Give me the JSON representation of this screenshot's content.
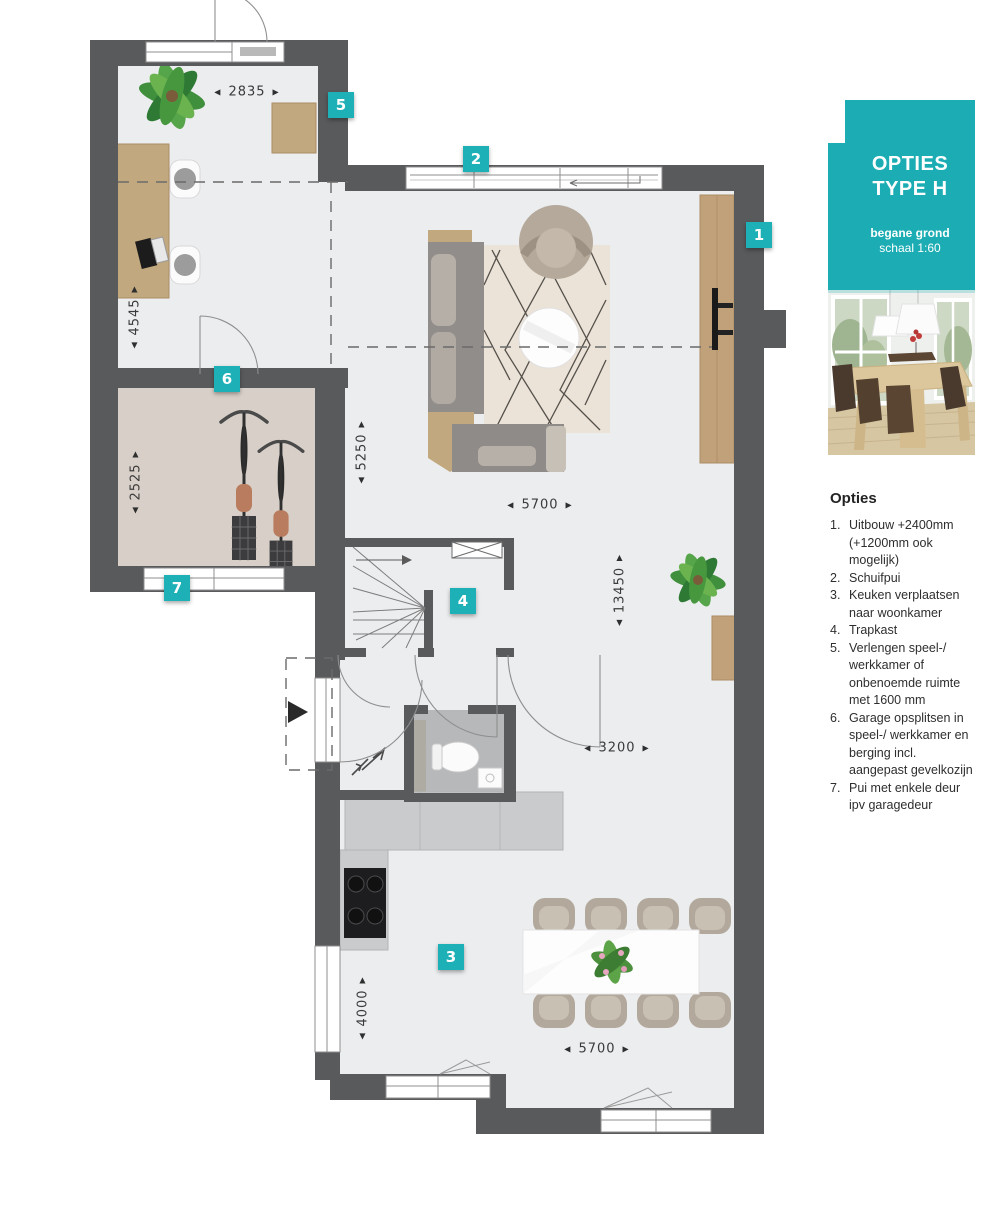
{
  "accent": "#1badb3",
  "sidebar": {
    "header": {
      "title1": "OPTIES",
      "title2": "TYPE H",
      "sub1": "begane grond",
      "sub2": "schaal 1:60"
    },
    "photo": {
      "description": "dining-room-photo"
    },
    "options": {
      "heading": "Opties",
      "items": [
        {
          "num": "1.",
          "text": "Uitbouw +2400mm (+1200mm ook mogelijk)"
        },
        {
          "num": "2.",
          "text": "Schuifpui"
        },
        {
          "num": "3.",
          "text": "Keuken verplaatsen naar woonkamer"
        },
        {
          "num": "4.",
          "text": "Trapkast"
        },
        {
          "num": "5.",
          "text": "Verlengen speel-/ werkkamer of onbenoemde ruimte met 1600 mm"
        },
        {
          "num": "6.",
          "text": "Garage opsplitsen in speel-/ werkkamer en berging incl. aangepast gevelkozijn"
        },
        {
          "num": "7.",
          "text": "Pui met enkele deur ipv garagedeur"
        }
      ]
    }
  },
  "plan": {
    "glyphs": {
      "left": "◀",
      "right": "▶",
      "up": "▲",
      "down": "▼"
    },
    "badges": [
      {
        "label": "1"
      },
      {
        "label": "2"
      },
      {
        "label": "3"
      },
      {
        "label": "4"
      },
      {
        "label": "5"
      },
      {
        "label": "6"
      },
      {
        "label": "7"
      }
    ],
    "dimensions": [
      {
        "value": "2835"
      },
      {
        "value": "4545"
      },
      {
        "value": "2525"
      },
      {
        "value": "5250"
      },
      {
        "value": "5700"
      },
      {
        "value": "13450"
      },
      {
        "value": "3200"
      },
      {
        "value": "4000"
      },
      {
        "value": "5700"
      }
    ]
  }
}
